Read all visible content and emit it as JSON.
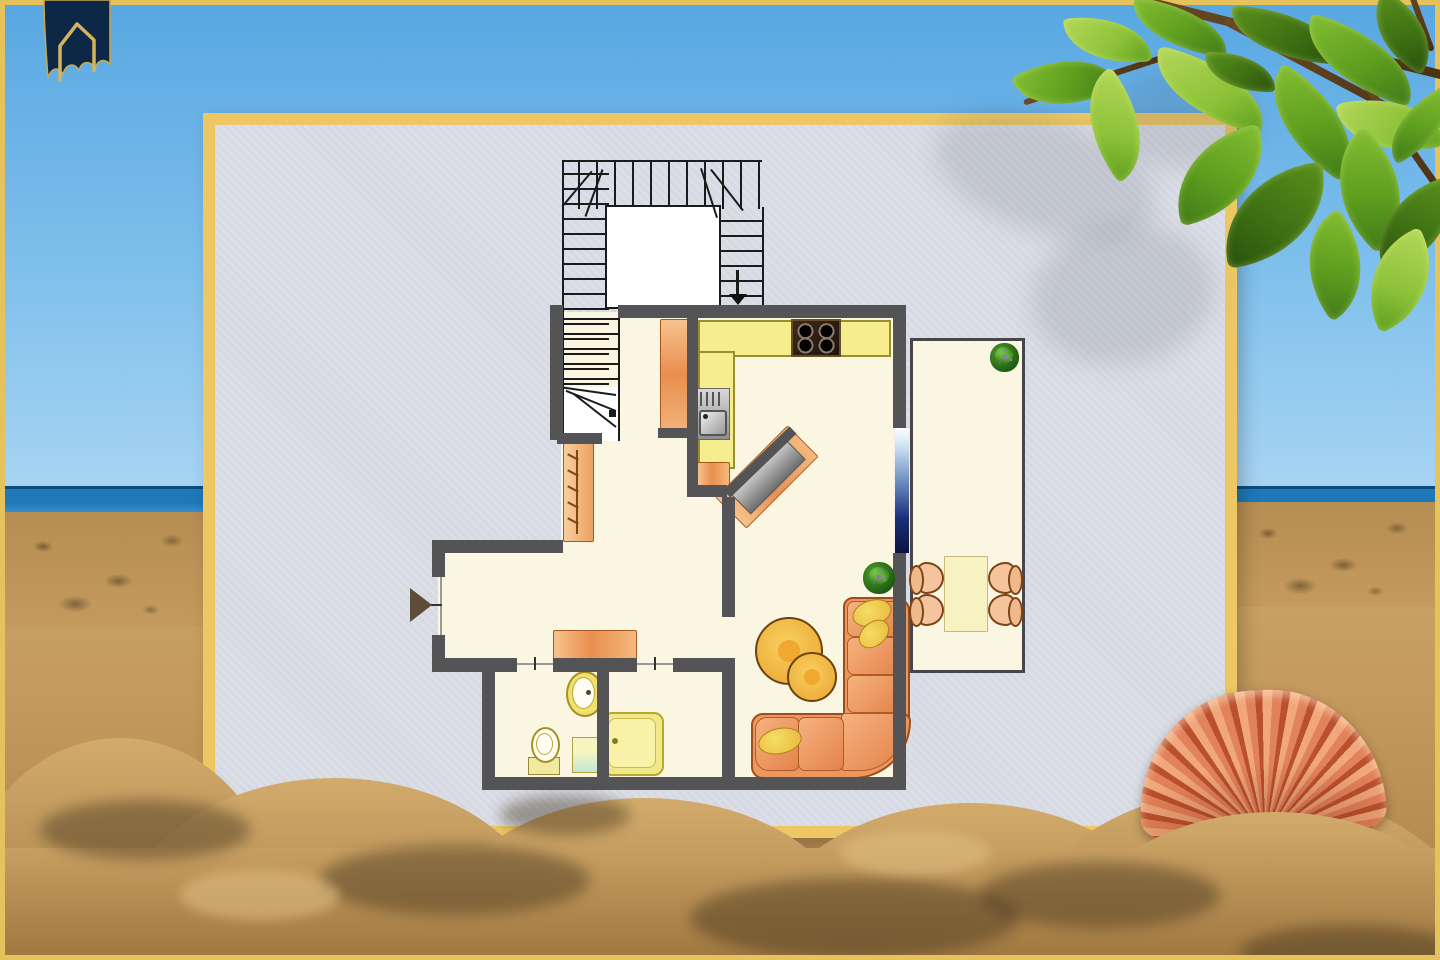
{
  "scene": {
    "backdrop": "beach-photo",
    "board": "apartment-floor-plan-poster",
    "visible_text": "none"
  },
  "icons": [
    "house-logo",
    "u-shaped-staircase",
    "down-arrow",
    "entrance-arrow",
    "stove-burners",
    "kitchen-sink",
    "tall-cabinet",
    "coat-hooks",
    "sideboard",
    "diagonal-sideboard",
    "corner-sofa",
    "pillows",
    "coffee-tables",
    "potted-plant",
    "dining-table",
    "chair",
    "toilet",
    "washbasin",
    "shower",
    "glass-door",
    "scallop-shell",
    "leaf-branch"
  ],
  "colors": {
    "sky_top": "#58a7e2",
    "sky_bottom": "#a8d4f2",
    "sea": "#1f78b8",
    "sea_dark": "#0d4a80",
    "sand": "#c49a5e",
    "poster_border": "#ecc764",
    "poster_bg": "#d7dae3",
    "frame_gold": "#e6c25c",
    "wall": "#545457",
    "room": "#faf6e2",
    "counter": "#f6ee8e",
    "counter_border": "#9a8f2f",
    "furniture_border": "#a8571e",
    "sofa": "#ec9660",
    "sofa_border": "#9e4d1c",
    "pillow": "#f2d24a",
    "dining_table": "#f8f2c2",
    "chair": "#f5c49c",
    "stove": "#2b1f16",
    "shower": "#f2e88a",
    "fixture_yellow": "#f0e070",
    "glass_dark": "#0a1440",
    "plant_green": "#2e7d22",
    "leaf_green": "#7cb82f",
    "leaf_dark": "#3f7a18",
    "branch_brown": "#5a3a1c",
    "shell_orange": "#d96a3f",
    "logo_navy": "#0d2746",
    "logo_gold": "#caa84e"
  }
}
